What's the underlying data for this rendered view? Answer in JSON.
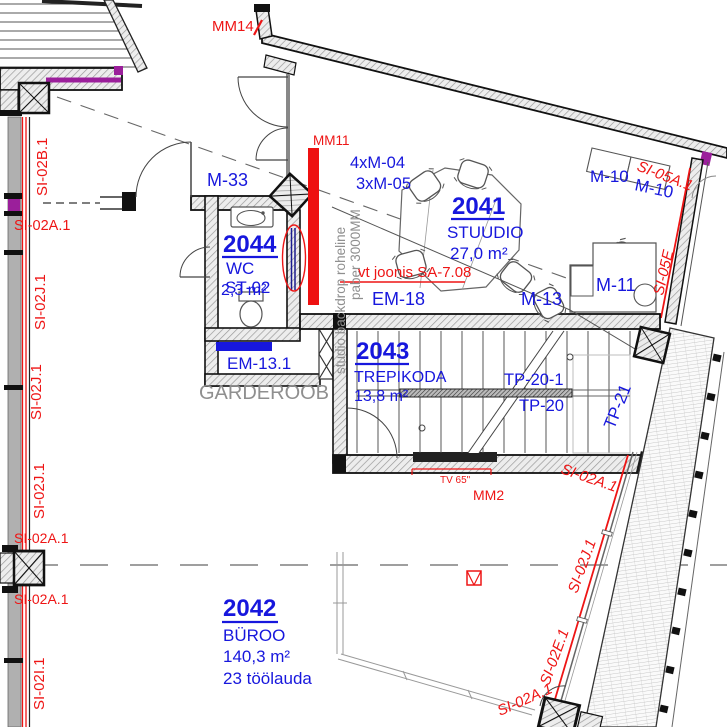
{
  "rooms": {
    "studio": {
      "number": "2041",
      "name": "STUUDIO",
      "area": "27,0 m²"
    },
    "byroo": {
      "number": "2042",
      "name": "BÜROO",
      "area": "140,3 m²",
      "desks": "23 töölauda"
    },
    "trepikoda": {
      "number": "2043",
      "name": "TREPIKODA",
      "area": "13,8 m²"
    },
    "wc": {
      "number": "2044",
      "name": "WC",
      "area": "2,3 m²"
    },
    "garderoob": {
      "name": "GARDEROOB"
    }
  },
  "codes": {
    "m33": "M-33",
    "m10": "M-10",
    "m11": "M-11",
    "m13": "M-13",
    "em18": "EM-18",
    "em131": "EM-13.1",
    "st02": "ST-02",
    "c404": "4xM-04",
    "c305": "3xM-05",
    "tp20": "TP-20",
    "tp201": "TP-20-1",
    "tp21": "TP-21"
  },
  "ann": {
    "mm14": "MM14",
    "mm11": "MM11",
    "mm2": "MM2",
    "tv": "TV 65\"",
    "see": "vt joonis SA-7.08",
    "backdrop1": "studio backdrop roheline",
    "backdrop2": "paber 3000MM",
    "si02a1": "SI-02A.1",
    "si02b1": "SI-02B.1",
    "si02j1": "SI-02J.1",
    "si02i1": "SI-02I.1",
    "si02e1": "SI-02E.1",
    "si05a1": "SI-05A.1",
    "si05e": "SI-05E"
  },
  "colors": {
    "label_blue": "#1717dd",
    "annotation_red": "#ee1515",
    "muted_gray": "#8f8f8f",
    "accent_magenta": "#9b1f9b",
    "backdrop_red": "#ee1111",
    "navy_line": "#1c1c8f"
  }
}
